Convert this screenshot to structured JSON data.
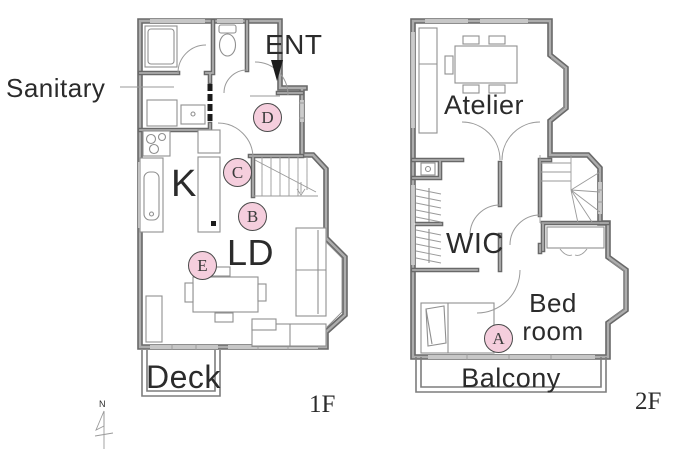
{
  "floor1": {
    "floor_label": "1F",
    "rooms": {
      "sanitary": "Sanitary",
      "entrance": "ENT",
      "kitchen": "K",
      "living_dining": "LD",
      "deck": "Deck"
    },
    "markers": {
      "b": "B",
      "c": "C",
      "d": "D",
      "e": "E"
    }
  },
  "floor2": {
    "floor_label": "2F",
    "rooms": {
      "atelier": "Atelier",
      "wic": "WIC",
      "bedroom_line1": "Bed",
      "bedroom_line2": "room",
      "balcony": "Balcony"
    },
    "markers": {
      "a": "A"
    }
  },
  "compass": {
    "north_label": "N"
  },
  "colors": {
    "marker_fill": "#f5cedd",
    "marker_border": "#4a4a4a",
    "wall_edge": "#696969",
    "wall_core": "#adadad",
    "line": "#8f8f8f",
    "text": "#2b2b2b",
    "entrance_arrow": "#1c1c1c"
  }
}
